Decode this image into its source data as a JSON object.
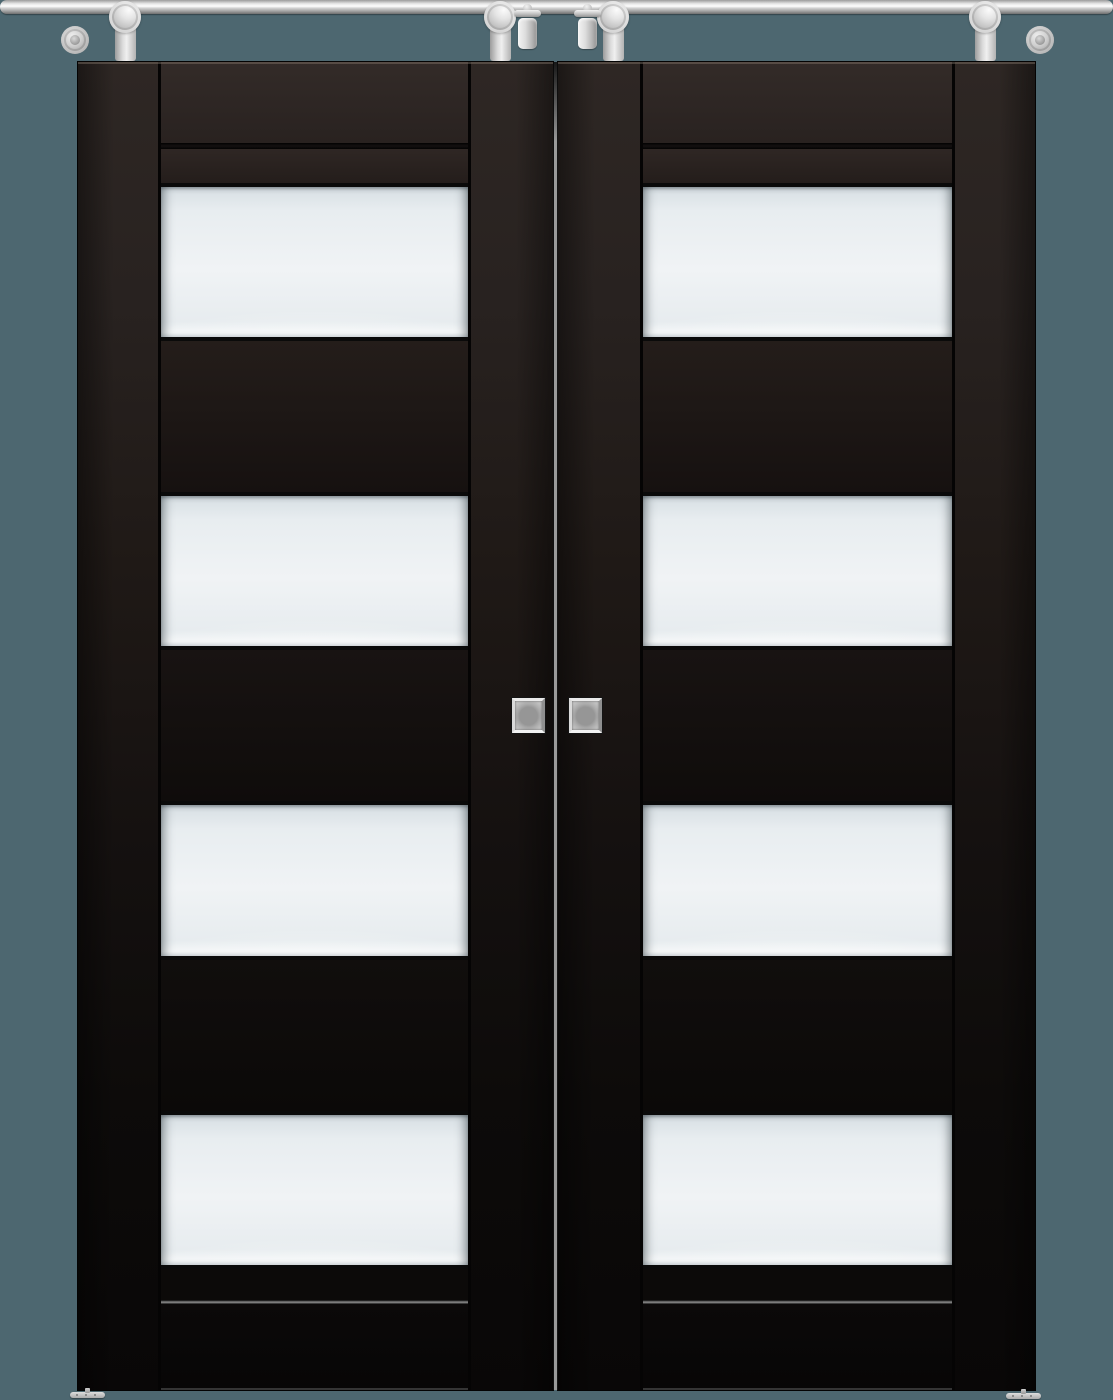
{
  "scene": {
    "label": "Double sliding barn doors with four frosted glass panels each and stainless top-rail hardware",
    "text_content": "none"
  },
  "colors": {
    "background": "#4d6770",
    "doorTop": "#332b28",
    "doorBottom": "#080706",
    "glass": "#f0f3f5",
    "silverLight": "#f0f0f0",
    "silverMid": "#c6c6c6",
    "silverDark": "#8a8a8a",
    "edgeBlack": "#050505"
  },
  "hardware": {
    "rail": "stainless-steel sliding rail",
    "hanger_count": 4,
    "stopper_count": 2,
    "wall_mount_count": 2,
    "floor_guide_count": 2,
    "handle_type": "square flush pull"
  },
  "doors": [
    {
      "id": "left",
      "finish": "black-espresso",
      "glass_panels": 4
    },
    {
      "id": "right",
      "finish": "black-espresso",
      "glass_panels": 4
    }
  ]
}
